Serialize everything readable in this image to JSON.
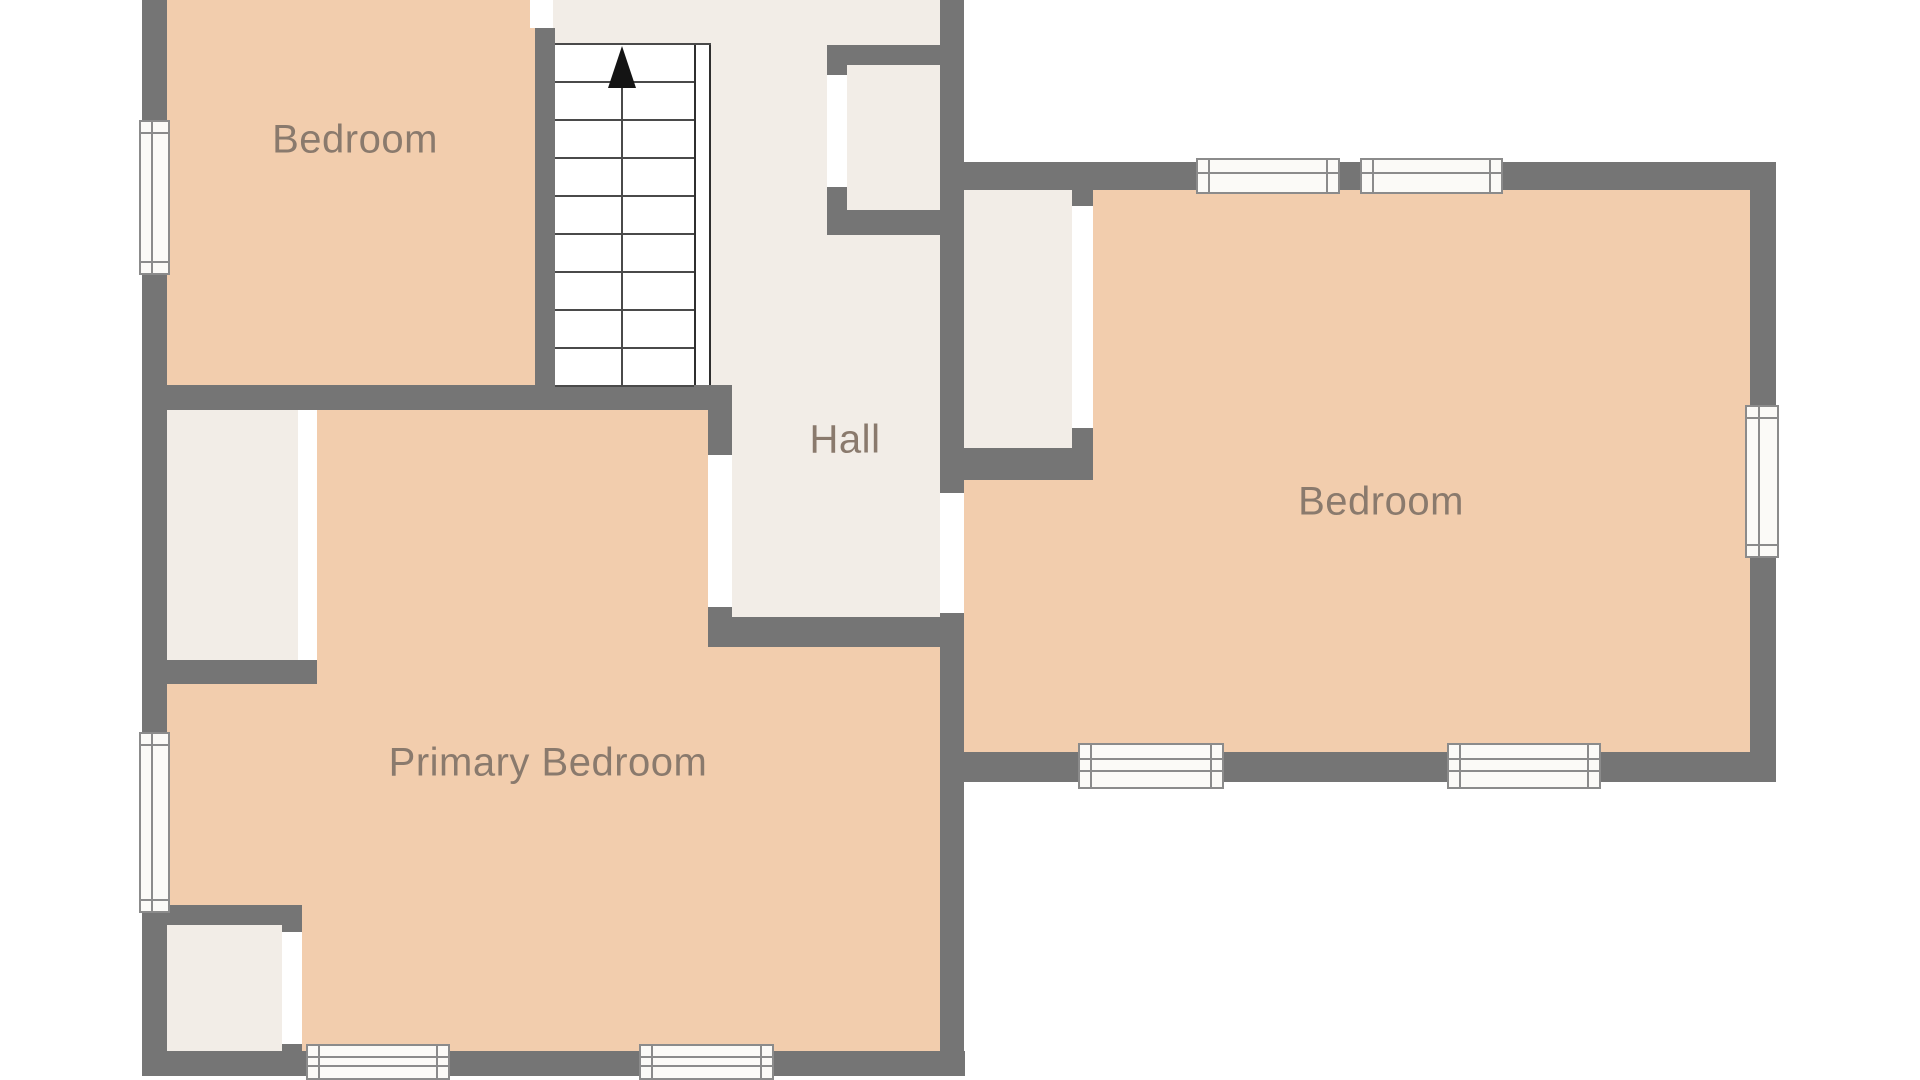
{
  "canvas": {
    "width": 1920,
    "height": 1080,
    "background": "#ffffff"
  },
  "palette": {
    "wall": "#757575",
    "room_fill": "#f2cdad",
    "hall_fill": "#f2ede7",
    "closet_fill": "#f2ede7",
    "door_fill": "#ffffff",
    "window_fill": "#fbfaf7",
    "window_line": "#8b8b8b",
    "stair_line": "#4a4a4a",
    "stair_rail": "#2f2f2f",
    "arrow": "#141414",
    "label_text": "#8a7a6d"
  },
  "labels": [
    {
      "id": "room-label-bedroom-top-left",
      "text": "Bedroom",
      "x": 355,
      "y": 140
    },
    {
      "id": "room-label-hall",
      "text": "Hall",
      "x": 845,
      "y": 440
    },
    {
      "id": "room-label-bedroom-right",
      "text": "Bedroom",
      "x": 1381,
      "y": 502
    },
    {
      "id": "room-label-primary-bedroom",
      "text": "Primary Bedroom",
      "x": 548,
      "y": 763
    }
  ],
  "floors": [
    {
      "id": "floor-bedroom-top-left",
      "x": 167,
      "y": 0,
      "w": 368,
      "h": 385,
      "fill": "room_fill"
    },
    {
      "id": "floor-stair-landing",
      "x": 553,
      "y": 0,
      "w": 160,
      "h": 43,
      "fill": "hall_fill"
    },
    {
      "id": "floor-stairwell",
      "x": 555,
      "y": 43,
      "w": 156,
      "h": 342,
      "fill": "#ffffff"
    },
    {
      "id": "floor-hall",
      "x": 711,
      "y": 0,
      "w": 233,
      "h": 617,
      "fill": "hall_fill"
    },
    {
      "id": "floor-primary-upper",
      "x": 167,
      "y": 410,
      "w": 541,
      "h": 237,
      "fill": "room_fill"
    },
    {
      "id": "floor-primary-lower",
      "x": 167,
      "y": 647,
      "w": 773,
      "h": 404,
      "fill": "room_fill"
    },
    {
      "id": "floor-bedroom-right-upper",
      "x": 1093,
      "y": 190,
      "w": 657,
      "h": 290,
      "fill": "room_fill"
    },
    {
      "id": "floor-bedroom-right-lower",
      "x": 964,
      "y": 480,
      "w": 786,
      "h": 272,
      "fill": "room_fill"
    },
    {
      "id": "floor-hall-closet",
      "x": 847,
      "y": 65,
      "w": 97,
      "h": 145,
      "fill": "closet_fill"
    },
    {
      "id": "floor-bedroom-right-closet",
      "x": 964,
      "y": 190,
      "w": 108,
      "h": 258,
      "fill": "closet_fill"
    },
    {
      "id": "floor-primary-closet-upper",
      "x": 167,
      "y": 410,
      "w": 131,
      "h": 250,
      "fill": "closet_fill"
    },
    {
      "id": "floor-primary-closet-lower",
      "x": 167,
      "y": 925,
      "w": 115,
      "h": 126,
      "fill": "closet_fill"
    }
  ],
  "walls": [
    {
      "id": "wall-outer-left",
      "x": 142,
      "y": 0,
      "w": 25,
      "h": 1076
    },
    {
      "id": "wall-outer-bottom",
      "x": 142,
      "y": 1051,
      "w": 823,
      "h": 25
    },
    {
      "id": "wall-bedroom1-bottom",
      "x": 142,
      "y": 385,
      "w": 566,
      "h": 25
    },
    {
      "id": "wall-stair-divider",
      "x": 535,
      "y": 28,
      "w": 20,
      "h": 357
    },
    {
      "id": "wall-hall-west-upper",
      "x": 708,
      "y": 385,
      "w": 24,
      "h": 70
    },
    {
      "id": "wall-hall-west-lower",
      "x": 708,
      "y": 607,
      "w": 24,
      "h": 40
    },
    {
      "id": "wall-hall-bottom",
      "x": 708,
      "y": 617,
      "w": 236,
      "h": 30
    },
    {
      "id": "wall-hall-east-upper",
      "x": 940,
      "y": 0,
      "w": 24,
      "h": 493
    },
    {
      "id": "wall-hall-east-lower",
      "x": 940,
      "y": 613,
      "w": 24,
      "h": 438
    },
    {
      "id": "wall-bedroom-right-top",
      "x": 940,
      "y": 162,
      "w": 836,
      "h": 28
    },
    {
      "id": "wall-outer-right",
      "x": 1750,
      "y": 162,
      "w": 26,
      "h": 620
    },
    {
      "id": "wall-bedroom-right-bottom",
      "x": 940,
      "y": 752,
      "w": 836,
      "h": 30
    },
    {
      "id": "wall-rb-closet-bottom",
      "x": 940,
      "y": 448,
      "w": 153,
      "h": 32
    },
    {
      "id": "wall-rb-closet-jamb-top",
      "x": 1072,
      "y": 190,
      "w": 21,
      "h": 16
    },
    {
      "id": "wall-rb-closet-jamb-bottom",
      "x": 1072,
      "y": 428,
      "w": 21,
      "h": 20
    },
    {
      "id": "wall-hall-closet-top",
      "x": 827,
      "y": 45,
      "w": 137,
      "h": 20
    },
    {
      "id": "wall-hall-closet-bottom",
      "x": 827,
      "y": 210,
      "w": 137,
      "h": 25
    },
    {
      "id": "wall-hall-closet-jamb-top",
      "x": 827,
      "y": 45,
      "w": 20,
      "h": 30
    },
    {
      "id": "wall-hall-closet-jamb-bottom",
      "x": 827,
      "y": 187,
      "w": 20,
      "h": 48
    },
    {
      "id": "wall-primary-closet-upper-bottom",
      "x": 142,
      "y": 660,
      "w": 175,
      "h": 24
    },
    {
      "id": "wall-primary-closet-lower-top",
      "x": 142,
      "y": 905,
      "w": 160,
      "h": 20
    },
    {
      "id": "wall-primary-closet-lower-jamb-top",
      "x": 282,
      "y": 905,
      "w": 20,
      "h": 27
    },
    {
      "id": "wall-primary-closet-lower-jamb-bottom",
      "x": 282,
      "y": 1044,
      "w": 20,
      "h": 7
    }
  ],
  "doors": [
    {
      "id": "door-bedroom-top-left",
      "x": 530,
      "y": 0,
      "w": 23,
      "h": 28
    },
    {
      "id": "door-hall-to-primary",
      "x": 708,
      "y": 455,
      "w": 24,
      "h": 152
    },
    {
      "id": "door-hall-to-bedroom-right",
      "x": 940,
      "y": 493,
      "w": 24,
      "h": 120
    },
    {
      "id": "door-hall-closet",
      "x": 827,
      "y": 75,
      "w": 20,
      "h": 112
    },
    {
      "id": "door-rb-closet",
      "x": 1072,
      "y": 206,
      "w": 21,
      "h": 222
    },
    {
      "id": "door-primary-closet-upper",
      "x": 298,
      "y": 410,
      "w": 19,
      "h": 250
    },
    {
      "id": "door-primary-closet-lower",
      "x": 282,
      "y": 932,
      "w": 20,
      "h": 112
    }
  ],
  "windows": [
    {
      "id": "window-left-top",
      "orientation": "v",
      "x": 139,
      "y": 120,
      "w": 31,
      "h": 155,
      "lines": 1
    },
    {
      "id": "window-left-bottom",
      "orientation": "v",
      "x": 139,
      "y": 732,
      "w": 31,
      "h": 181,
      "lines": 1
    },
    {
      "id": "window-top-1",
      "orientation": "h",
      "x": 1196,
      "y": 158,
      "w": 144,
      "h": 36,
      "lines": 1
    },
    {
      "id": "window-top-2",
      "orientation": "h",
      "x": 1360,
      "y": 158,
      "w": 143,
      "h": 36,
      "lines": 1
    },
    {
      "id": "window-right",
      "orientation": "v",
      "x": 1745,
      "y": 405,
      "w": 34,
      "h": 153,
      "lines": 1
    },
    {
      "id": "window-rb-bottom-1",
      "orientation": "h",
      "x": 1078,
      "y": 743,
      "w": 146,
      "h": 46,
      "lines": 2
    },
    {
      "id": "window-rb-bottom-2",
      "orientation": "h",
      "x": 1447,
      "y": 743,
      "w": 154,
      "h": 46,
      "lines": 2
    },
    {
      "id": "window-primary-bottom-1",
      "orientation": "h",
      "x": 306,
      "y": 1044,
      "w": 144,
      "h": 36,
      "lines": 2
    },
    {
      "id": "window-primary-bottom-2",
      "orientation": "h",
      "x": 639,
      "y": 1044,
      "w": 135,
      "h": 36,
      "lines": 2
    }
  ],
  "stairs": {
    "x": 555,
    "top": 43,
    "bottom": 385,
    "tread_right": 694,
    "tread_count": 10,
    "stringer": {
      "x": 694,
      "y": 45,
      "w": 17,
      "h": 340
    },
    "center_x": 622,
    "arrow_tip_y": 46,
    "arrow_base_y": 88,
    "arrow_half_width": 14,
    "direction": "up"
  }
}
